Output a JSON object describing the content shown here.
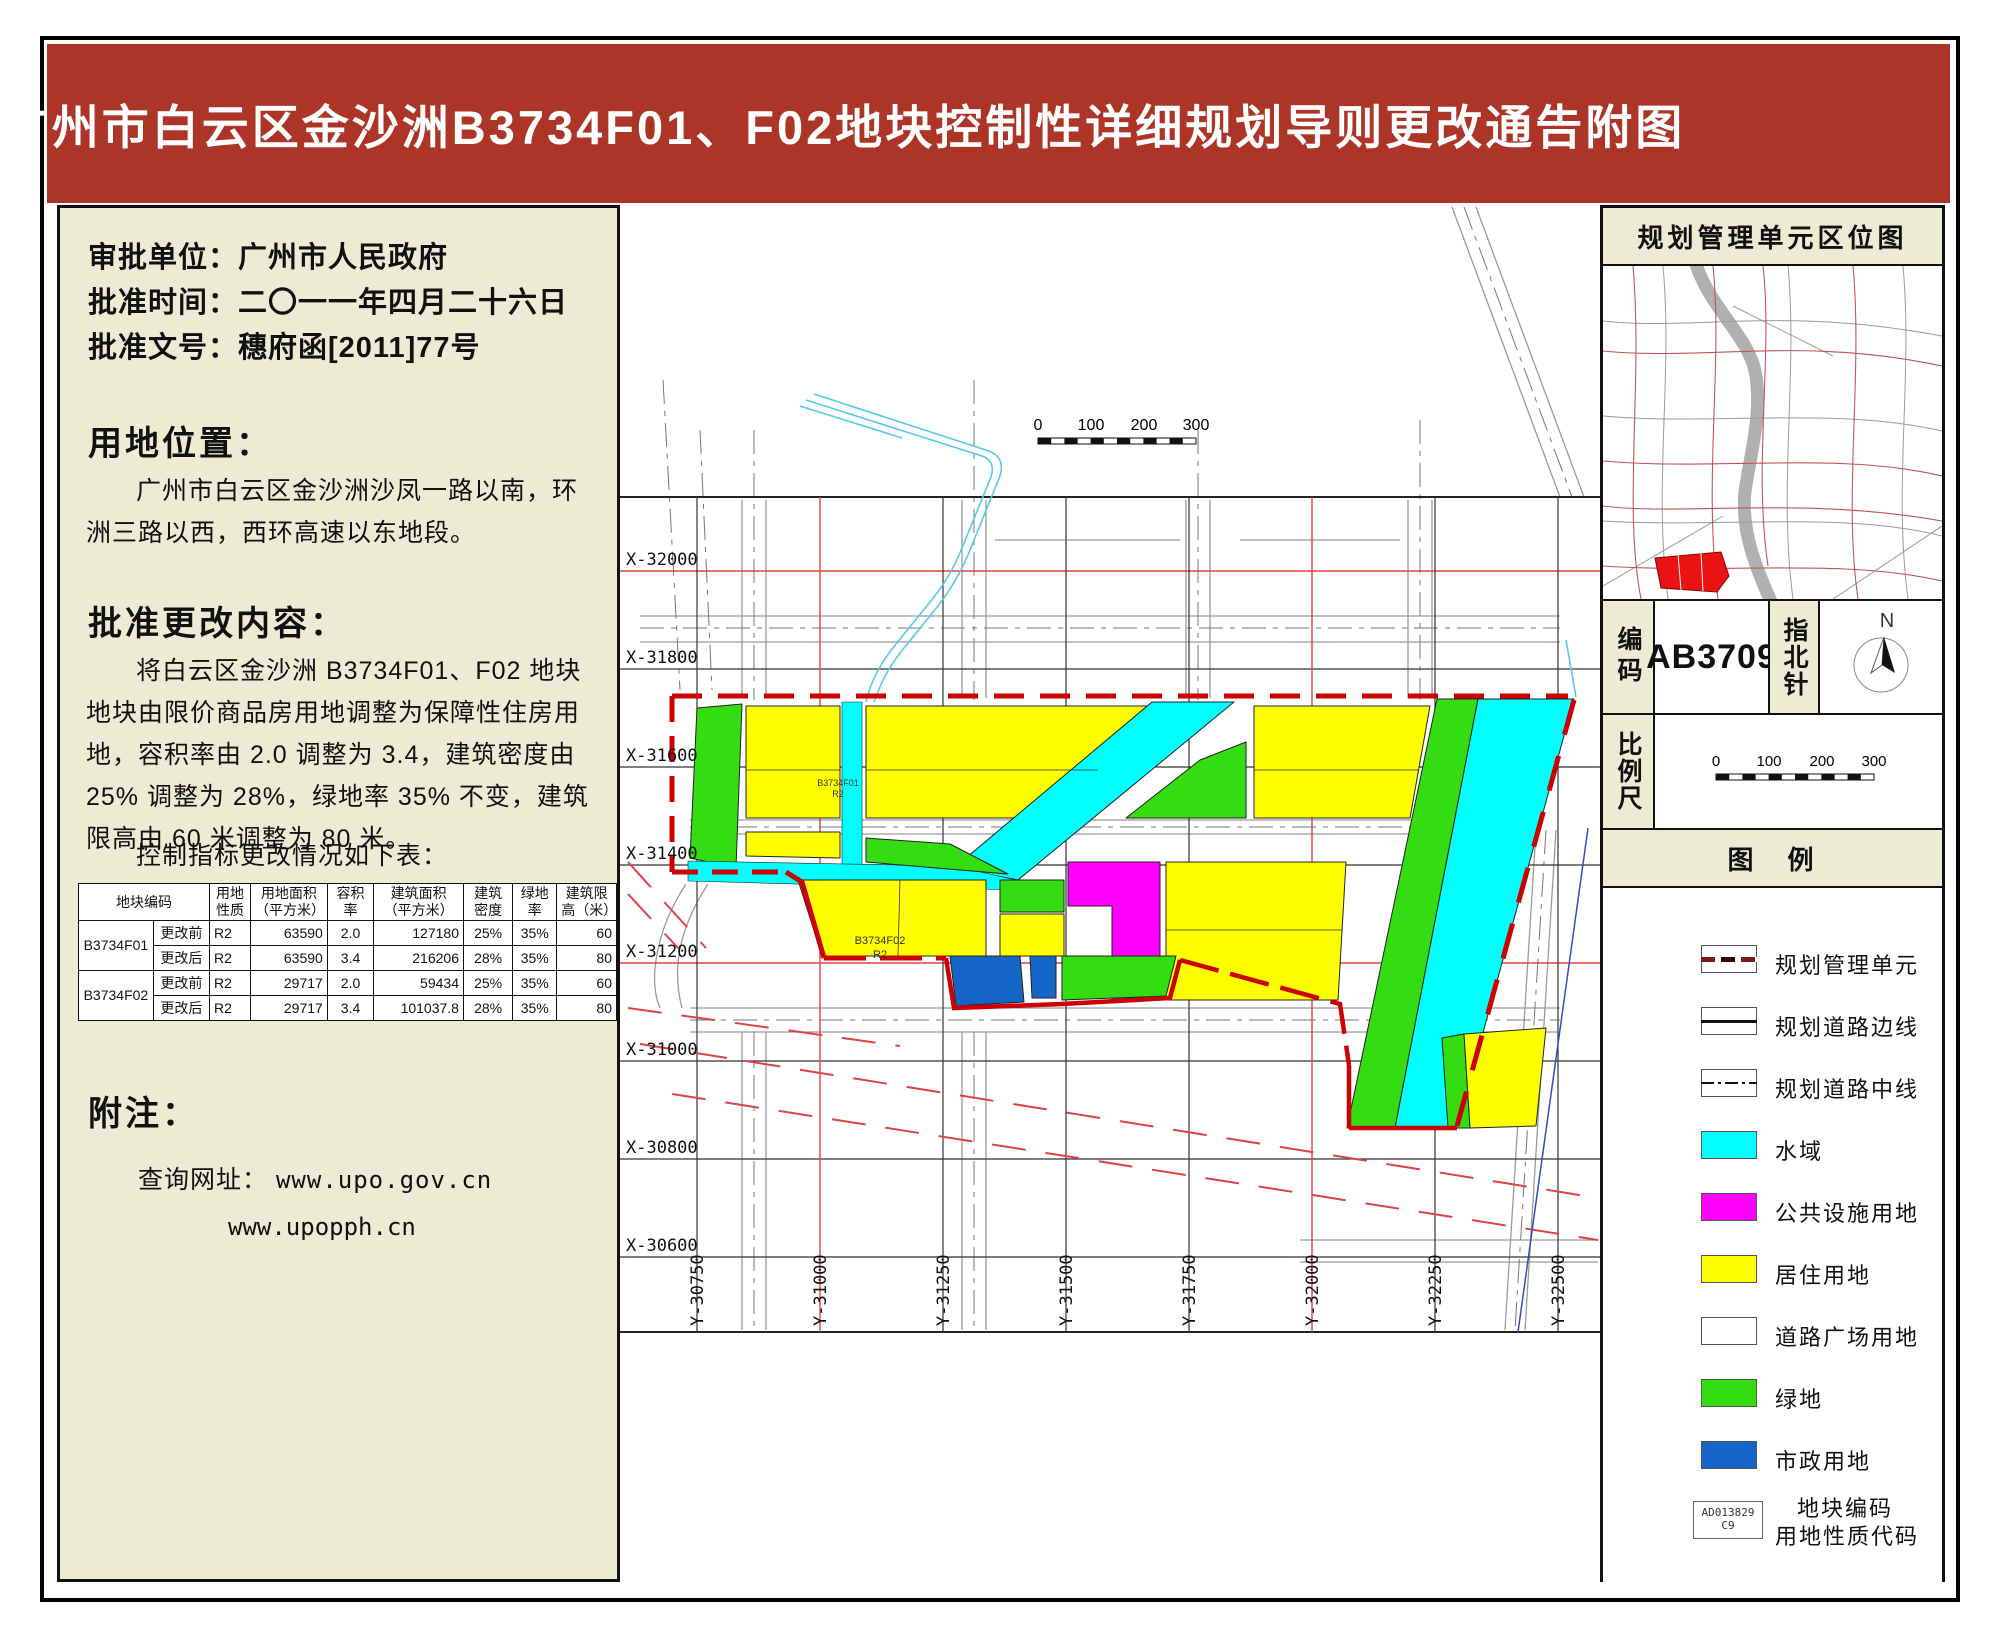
{
  "title": "广州市白云区金沙洲B3734F01、F02地块控制性详细规划导则更改通告附图",
  "left_panel": {
    "info": [
      {
        "label": "审批单位：",
        "value": "广州市人民政府"
      },
      {
        "label": "批准时间：",
        "value": "二〇一一年四月二十六日"
      },
      {
        "label": "批准文号：",
        "value": "穗府函[2011]77号"
      }
    ],
    "location_heading": "用地位置：",
    "location_text": "广州市白云区金沙洲沙凤一路以南，环洲三路以西，西环高速以东地段。",
    "change_heading": "批准更改内容：",
    "change_text": "将白云区金沙洲 B3734F01、F02 地块地块由限价商品房用地调整为保障性住房用地，容积率由 2.0 调整为 3.4，建筑密度由 25% 调整为 28%，绿地率 35% 不变，建筑限高由 60 米调整为 80 米。",
    "table_intro": "控制指标更改情况如下表：",
    "table": {
      "headers": [
        "地块编码",
        "用地性质",
        "用地面积（平方米）",
        "容积率",
        "建筑面积（平方米）",
        "建筑密度",
        "绿地率",
        "建筑限高（米）"
      ],
      "rows": [
        {
          "block": "B3734F01",
          "phase": "更改前",
          "cells": [
            "R2",
            "63590",
            "2.0",
            "127180",
            "25%",
            "35%",
            "60"
          ]
        },
        {
          "block": "B3734F01",
          "phase": "更改后",
          "cells": [
            "R2",
            "63590",
            "3.4",
            "216206",
            "28%",
            "35%",
            "80"
          ]
        },
        {
          "block": "B3734F02",
          "phase": "更改前",
          "cells": [
            "R2",
            "29717",
            "2.0",
            "59434",
            "25%",
            "35%",
            "60"
          ]
        },
        {
          "block": "B3734F02",
          "phase": "更改后",
          "cells": [
            "R2",
            "29717",
            "3.4",
            "101037.8",
            "28%",
            "35%",
            "80"
          ]
        }
      ]
    },
    "notes_heading": "附注：",
    "notes_label": "查询网址：",
    "urls": [
      "www.upo.gov.cn",
      "www.upopph.cn"
    ]
  },
  "map": {
    "x_labels": [
      "X-32000",
      "X-31800",
      "X-31600",
      "X-31400",
      "X-31200",
      "X-31000",
      "X-30800",
      "X-30600"
    ],
    "y_labels": [
      "Y-30750",
      "Y-31000",
      "Y-31250",
      "Y-31500",
      "Y-31750",
      "Y-32000",
      "Y-32250",
      "Y-32500"
    ],
    "scale_ticks": [
      "0",
      "100",
      "200",
      "300"
    ],
    "plots": [
      {
        "code": "B3734F01",
        "nature": "R2"
      },
      {
        "code": "B3734F02",
        "nature": "R2"
      }
    ],
    "accent_colors": {
      "grid_red": "#e04040",
      "boundary_red": "#cc0000",
      "stream_blue": "#56c8e8"
    }
  },
  "right_panel": {
    "location_map_title": "规划管理单元区位图",
    "code_label": "编码",
    "code_value": "AB3709",
    "north_label": "指北针",
    "north_letter": "N",
    "scale_label": "比例尺",
    "scale_ticks": [
      "0",
      "100",
      "200",
      "300"
    ],
    "legend_title": "图　例",
    "legend": [
      {
        "label": "规划管理单元",
        "swatch": "dashed-red-line",
        "color": "#7b1818"
      },
      {
        "label": "规划道路边线",
        "swatch": "solid-line",
        "color": "#111111"
      },
      {
        "label": "规划道路中线",
        "swatch": "dashdot-line",
        "color": "#111111"
      },
      {
        "label": "水域",
        "swatch": "fill",
        "color": "#00ffff"
      },
      {
        "label": "公共设施用地",
        "swatch": "fill",
        "color": "#ff00ff"
      },
      {
        "label": "居住用地",
        "swatch": "fill",
        "color": "#ffff00"
      },
      {
        "label": "道路广场用地",
        "swatch": "fill",
        "color": "#ffffff"
      },
      {
        "label": "绿地",
        "swatch": "fill",
        "color": "#33dd11"
      },
      {
        "label": "市政用地",
        "swatch": "fill",
        "color": "#1565c8"
      },
      {
        "label_line1": "地块编码",
        "label_line2": "用地性质代码",
        "swatch": "code-box",
        "sample_code": "AD013829",
        "sample_nature": "C9"
      }
    ]
  },
  "theme": {
    "header_red": "#ac3528",
    "panel_beige": "#edebd4"
  }
}
